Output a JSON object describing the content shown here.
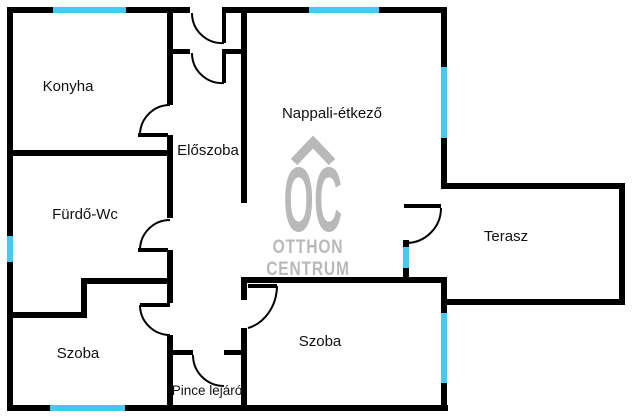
{
  "rooms": {
    "konyha": "Konyha",
    "eloszoba": "Előszoba",
    "nappali": "Nappali-étkező",
    "furdo": "Fürdő-Wc",
    "szoba_bal": "Szoba",
    "pince": "Pince lejáró",
    "szoba_jobb": "Szoba",
    "terasz": "Terasz"
  },
  "logo": {
    "brand": "OC",
    "line1": "OTTHON",
    "line2": "CENTRUM"
  },
  "colors": {
    "wall": "#000000",
    "window": "#45c8f2",
    "logo_gray": "#b9b9b9",
    "label": "#111111",
    "background": "#ffffff"
  }
}
